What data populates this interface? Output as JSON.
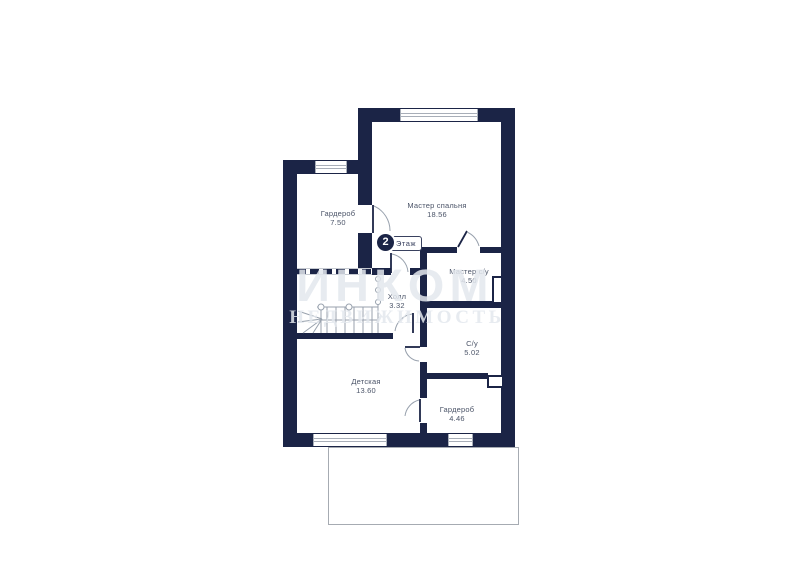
{
  "watermark": {
    "line1": "ИНКОМ",
    "line2": "недвижимость"
  },
  "floor_badge": {
    "number": "2",
    "label": "Этаж"
  },
  "rooms": [
    {
      "name": "Гардероб",
      "area": "7.50"
    },
    {
      "name": "Мастер спальня",
      "area": "18.56"
    },
    {
      "name": "Мастер с/у",
      "area": "4.50"
    },
    {
      "name": "Холл",
      "area": "3.32"
    },
    {
      "name": "С/у",
      "area": "5.02"
    },
    {
      "name": "Детская",
      "area": "13.60"
    },
    {
      "name": "Гардероб",
      "area": "4.46"
    }
  ],
  "colors": {
    "wall": "#1b2446",
    "label": "#4b5468",
    "watermark": "#e3e7ed",
    "line": "#98a1ad",
    "window_frame": "#a8aeb8"
  }
}
